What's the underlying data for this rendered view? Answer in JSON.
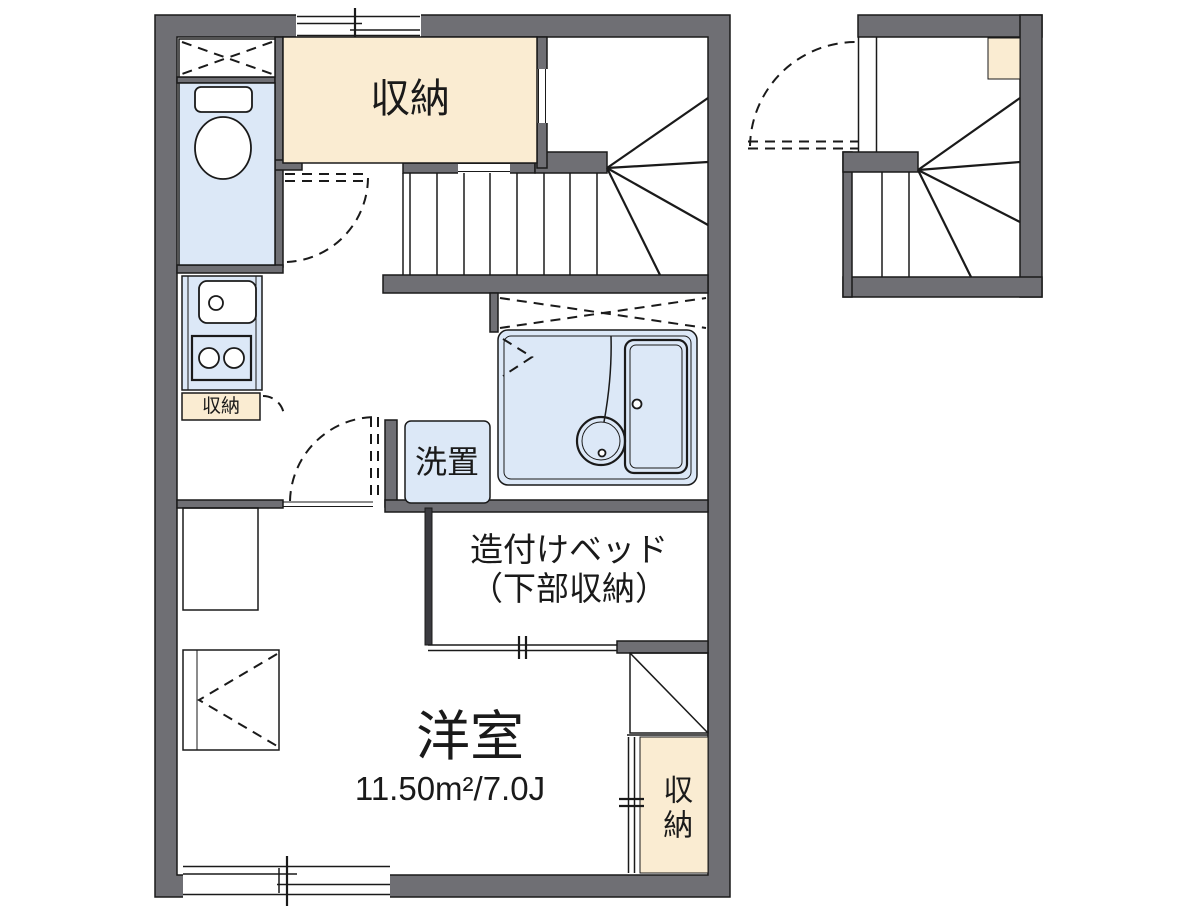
{
  "floorplan": {
    "rooms": {
      "storage_top": "収納",
      "washer": "洗置",
      "bed_line1": "造付けベッド",
      "bed_line2": "（下部収納）",
      "main_room": "洋室",
      "main_room_area": "11.50m²/7.0J",
      "kitchen_storage": "収納",
      "closet": "収納"
    },
    "colors": {
      "wall": "#6f6f74",
      "water": "#dce8f7",
      "storage": "#faecd2",
      "line": "#1a1a1a",
      "bg": "#ffffff"
    }
  }
}
